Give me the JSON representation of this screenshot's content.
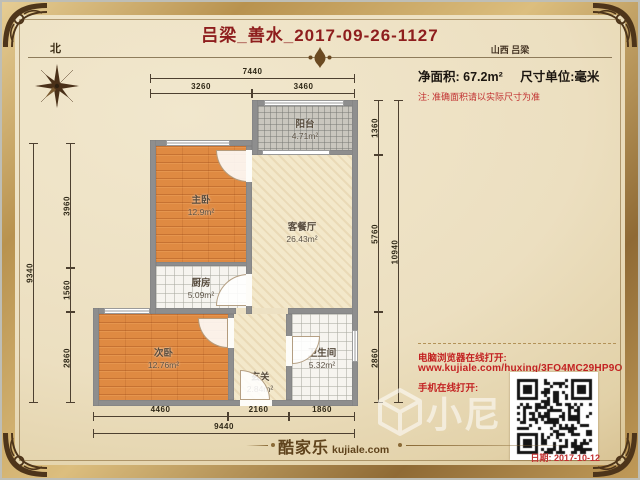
{
  "page": {
    "title": "吕梁_善水_2017-09-26-1127",
    "region": "山西 吕梁"
  },
  "meta": {
    "north": "北",
    "net_area_label": "净面积:",
    "net_area_value": "67.2m²",
    "unit_text": "尺寸单位:毫米",
    "note": "注: 准确面积请以实际尺寸为准"
  },
  "rooms": {
    "balcony": {
      "name": "阳台",
      "area": "4.71m²"
    },
    "master": {
      "name": "主卧",
      "area": "12.9m²"
    },
    "living": {
      "name": "客餐厅",
      "area": "26.43m²"
    },
    "kitchen": {
      "name": "厨房",
      "area": "5.09m²"
    },
    "second": {
      "name": "次卧",
      "area": "12.76m²"
    },
    "hall": {
      "name": "玄关",
      "area": "2.84m²"
    },
    "bath": {
      "name": "卫生间",
      "area": "5.32m²"
    }
  },
  "dims": {
    "top_total": "7440",
    "top_left": "3260",
    "top_right": "3460",
    "bottom_1": "4460",
    "bottom_2": "2160",
    "bottom_3": "1860",
    "bottom_total": "9440",
    "left_1": "3960",
    "left_2": "1560",
    "left_3": "2860",
    "left_total": "9340",
    "right_1": "1360",
    "right_2": "5760",
    "right_3": "2860",
    "right_total": "10940"
  },
  "links": {
    "pc_label": "电脑浏览器在线打开:",
    "url": "www.kujiale.com/huxing/3FO4MC29HP9O",
    "mobile_label": "手机在线打开:"
  },
  "footer": {
    "brand_cn": "酷家乐",
    "brand_en": "kujiale.com",
    "date": "日期: 2017-10-12"
  },
  "watermark": {
    "text": "小尼"
  },
  "colors": {
    "accent_red": "#8e1d1d",
    "link_red": "#c32222",
    "wall_grey": "#8e8e8e",
    "wood": "#df8a42",
    "gold": "#b8924f"
  }
}
